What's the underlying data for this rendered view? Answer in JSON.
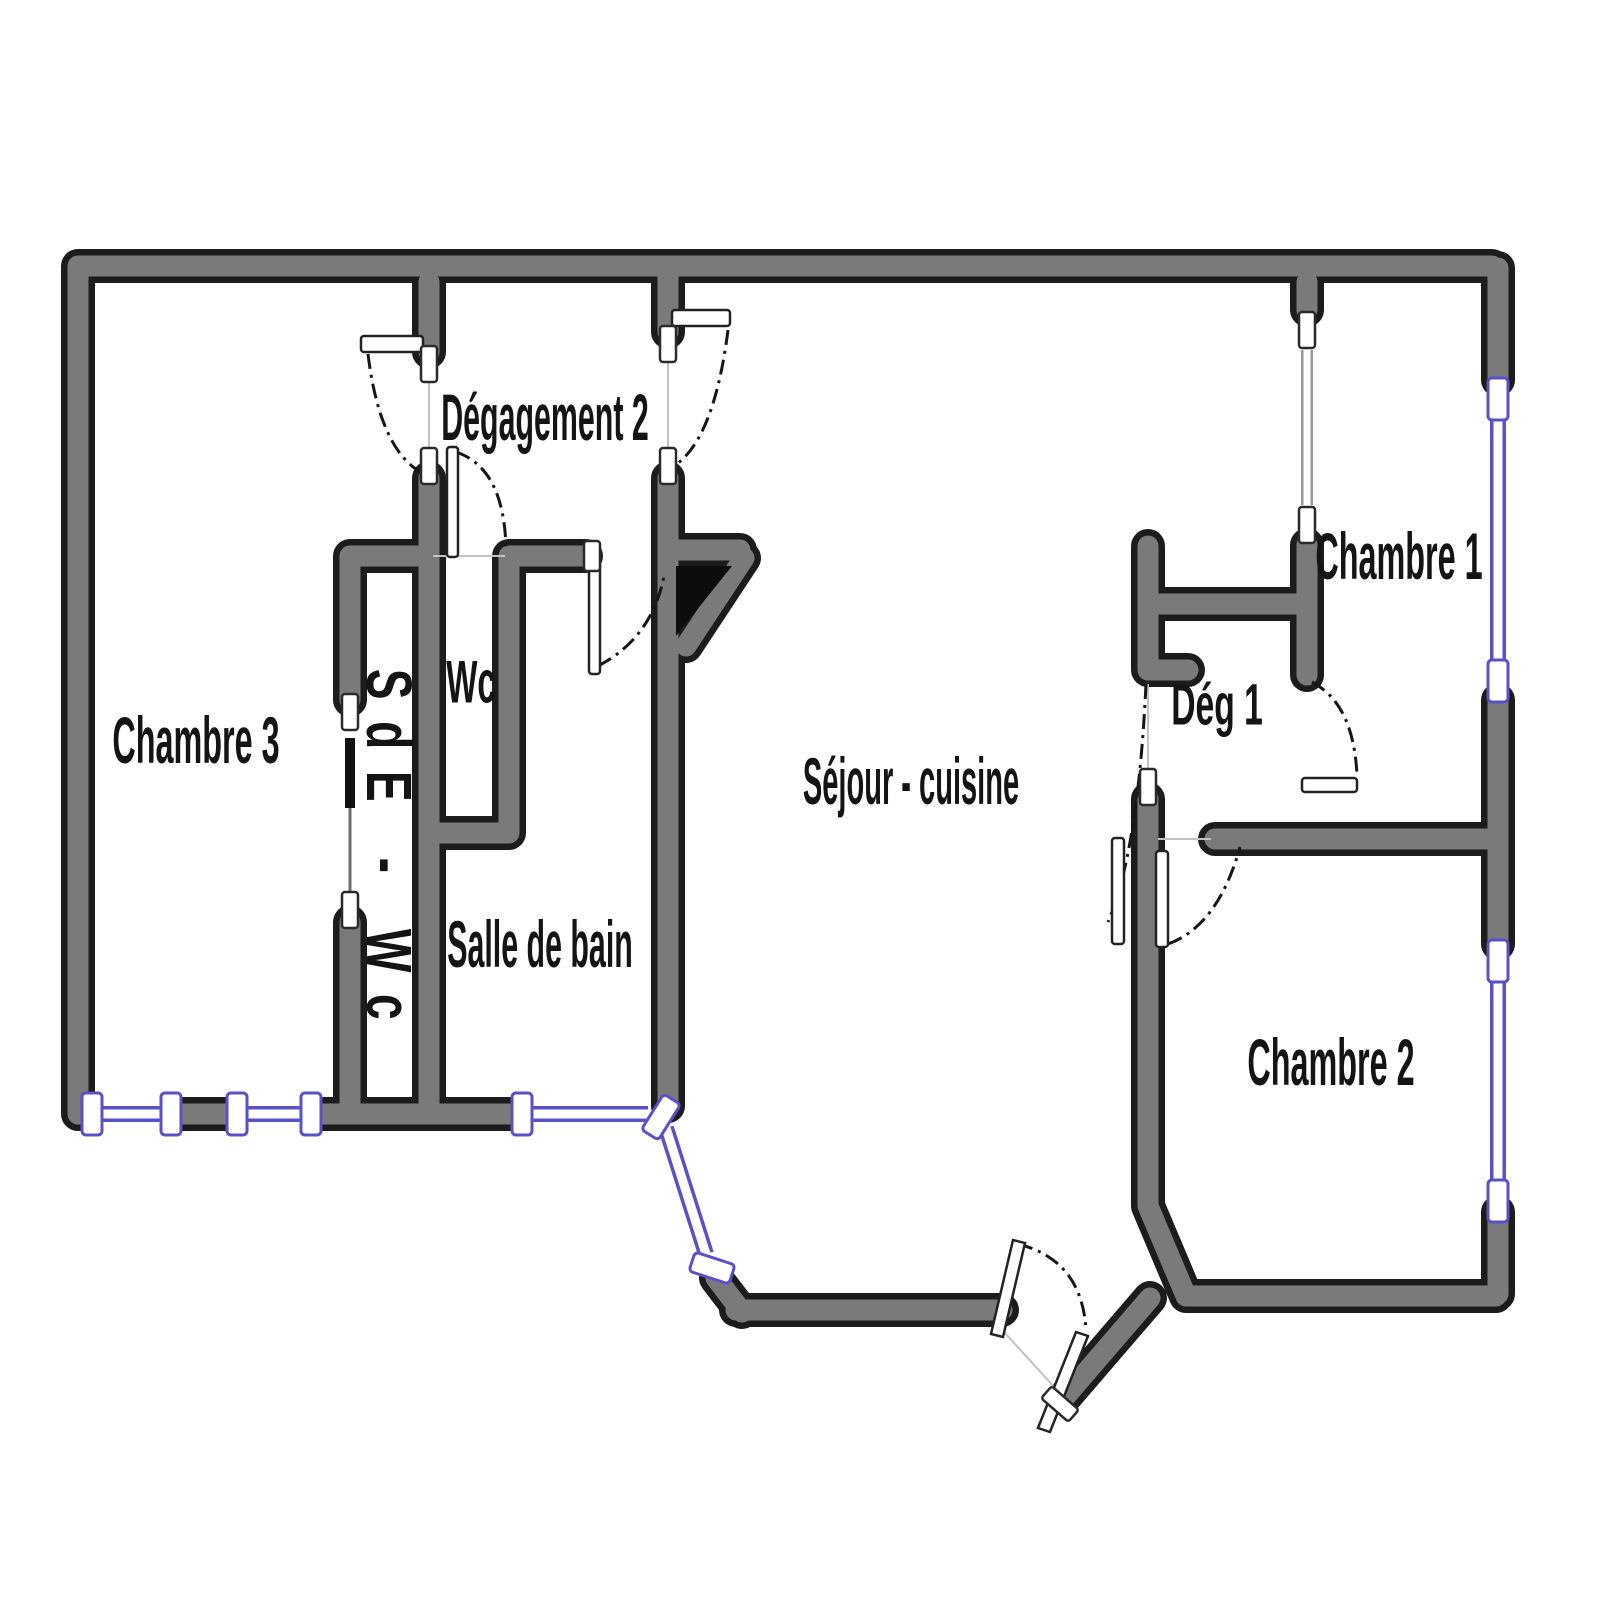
{
  "floorplan": {
    "background_color": "#ffffff",
    "wall_core_color": "#7a7a7a",
    "wall_outline_color": "#1c1c1c",
    "window_color": "#5a50c8",
    "door_leaf_color": "#ffffff",
    "door_arc_style": "dash-dot",
    "rooms": [
      {
        "id": "chambre_3",
        "label": "Chambre 3"
      },
      {
        "id": "sde_wc",
        "label": "SdE - Wc"
      },
      {
        "id": "wc",
        "label": "Wc"
      },
      {
        "id": "degagement_2",
        "label": "Dégagement 2"
      },
      {
        "id": "salle_de_bain",
        "label": "Salle de bain"
      },
      {
        "id": "sejour_cuisine",
        "label": "Séjour - cuisine"
      },
      {
        "id": "deg_1",
        "label": "Dég 1"
      },
      {
        "id": "chambre_1",
        "label": "Chambre 1"
      },
      {
        "id": "chambre_2",
        "label": "Chambre 2"
      }
    ]
  }
}
